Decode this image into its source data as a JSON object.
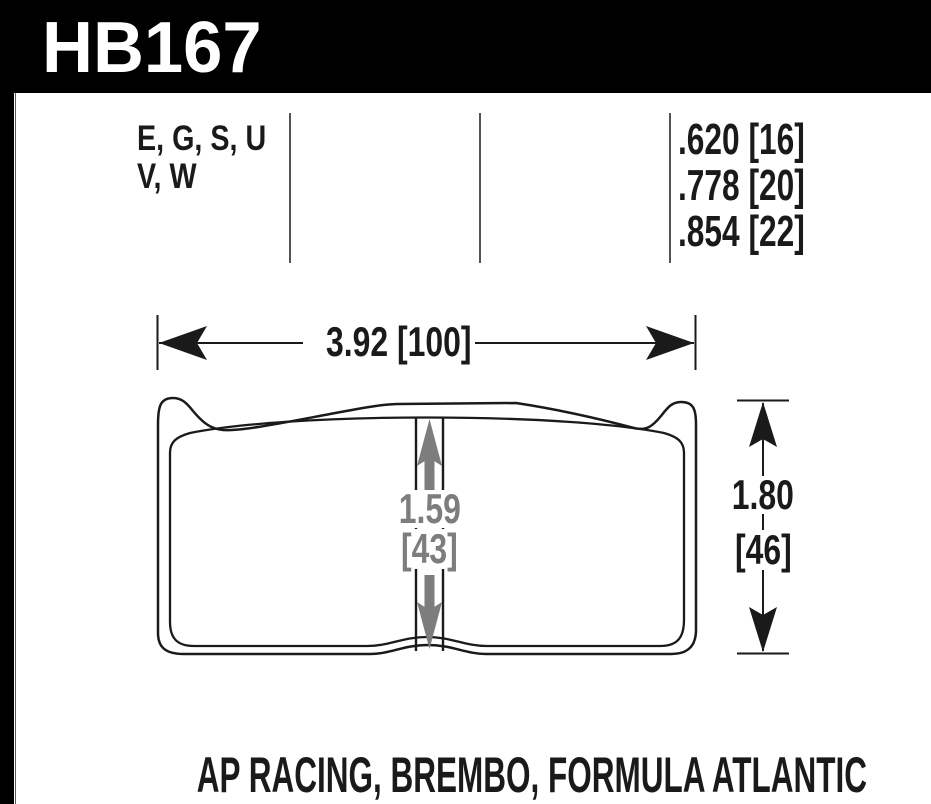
{
  "part_number": "HB167",
  "spec_table": {
    "compound_lines": [
      "E, G, S, U",
      "V, W"
    ],
    "thickness_lines": [
      ".620 [16]",
      ".778 [20]",
      ".854 [22]"
    ]
  },
  "dimensions": {
    "overall_width": "3.92 [100]",
    "overall_height": {
      "inches": "1.80",
      "millimeters": "[46]"
    },
    "center_height": {
      "inches": "1.59",
      "millimeters": "[43]"
    }
  },
  "applications": "AP RACING, BREMBO, FORMULA ATLANTIC",
  "colors": {
    "header_background": "#000000",
    "ink": "#1a1a1a",
    "dimension_gray": "#7d7d7d",
    "table_divider": "#555555",
    "background": "#ffffff"
  }
}
